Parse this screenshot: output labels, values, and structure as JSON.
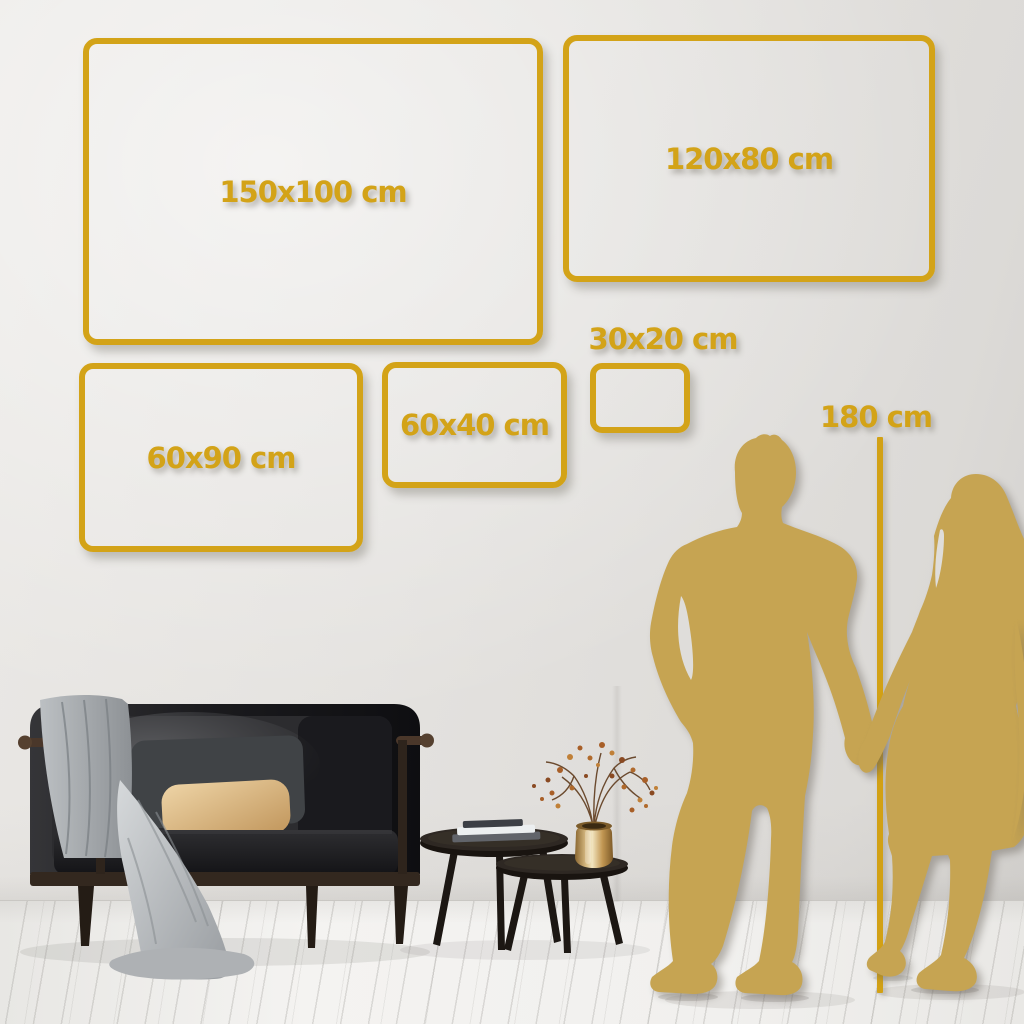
{
  "size_guide": {
    "frames": [
      {
        "label": "150x100 cm",
        "width_cm": 150,
        "height_cm": 100
      },
      {
        "label": "120x80 cm",
        "width_cm": 120,
        "height_cm": 80
      },
      {
        "label": "60x90 cm",
        "width_cm": 60,
        "height_cm": 90
      },
      {
        "label": "60x40 cm",
        "width_cm": 60,
        "height_cm": 40
      },
      {
        "label": "30x20 cm",
        "width_cm": 30,
        "height_cm": 20
      }
    ],
    "person_height_label": "180 cm"
  },
  "colors": {
    "accent_gold": "#D3A318",
    "silhouette_gold": "#C6A452",
    "wall": "#E3E1DE",
    "floor": "#F1F0EE"
  },
  "scene": {
    "icons": [
      "man-silhouette-icon",
      "woman-silhouette-icon",
      "height-line-icon",
      "sofa-icon",
      "blanket-icon",
      "pillow-icon",
      "coffee-tables-icon",
      "books-icon",
      "vase-icon",
      "dried-branch-icon"
    ]
  }
}
